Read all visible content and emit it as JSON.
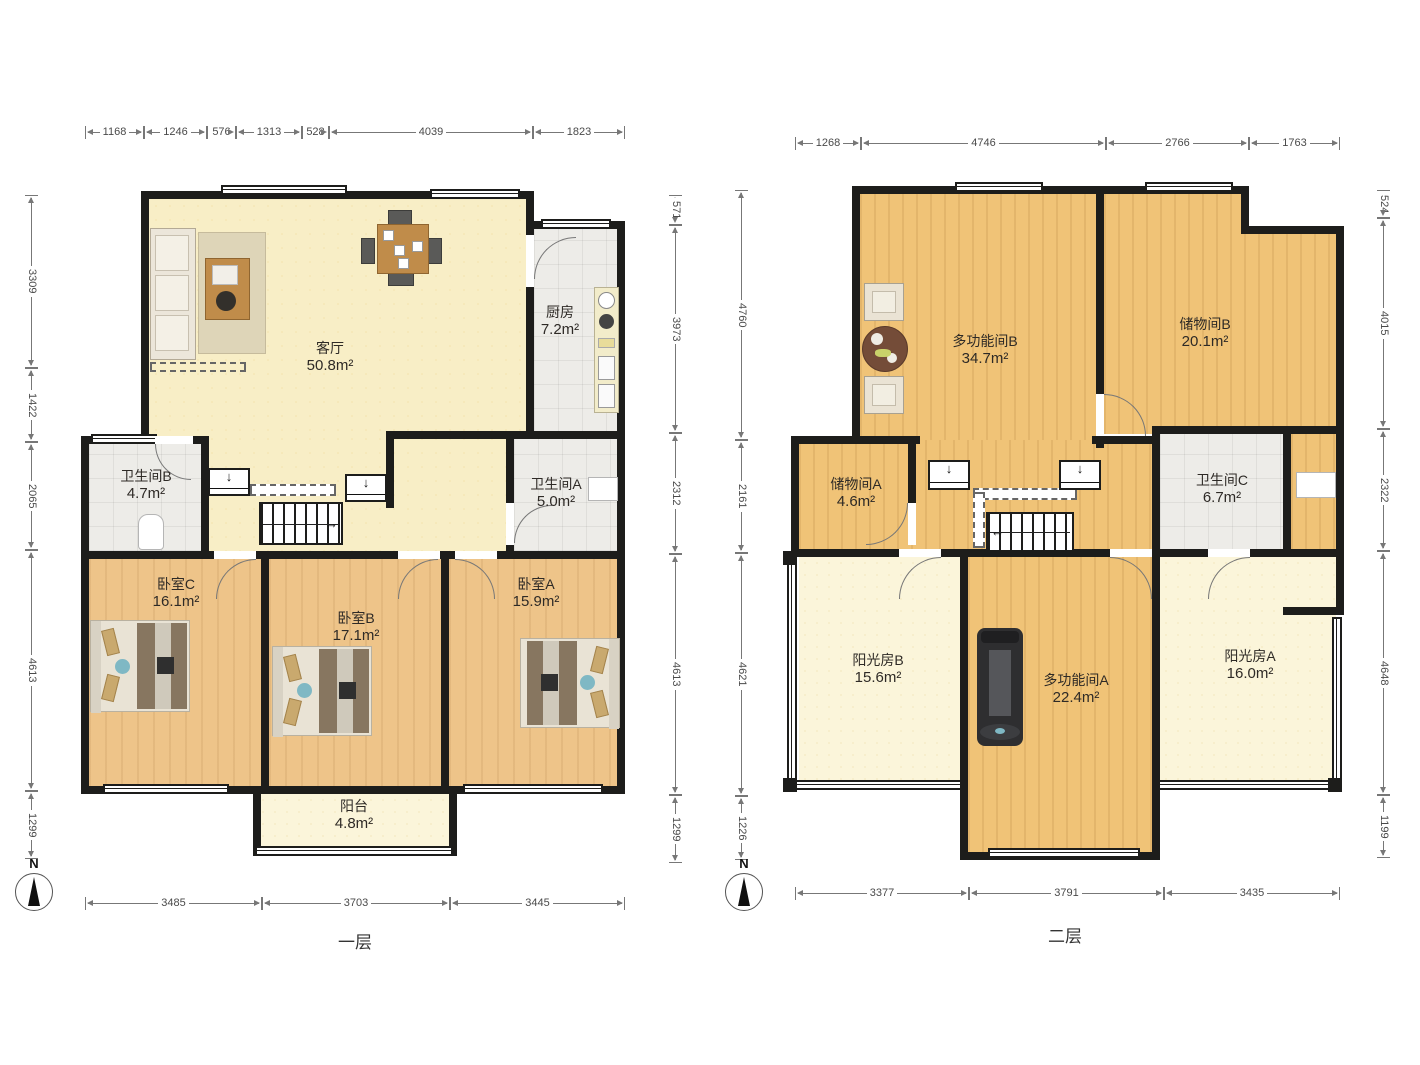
{
  "palette": {
    "wall": "#1d1d1b",
    "living_floor": "#f8eec6",
    "bedroom_floor": "#eec489",
    "upper_floor": "#f0c377",
    "tile_floor": "#edece8",
    "sunroom_floor": "#fbf5da",
    "dimension_text": "#4a4a4a"
  },
  "compass": {
    "north": "N"
  },
  "icons": {
    "down_arrow": "↓",
    "arrow_right": "→",
    "arrow_left": "←"
  },
  "floor1": {
    "label": "一层",
    "rooms": [
      {
        "name": "客厅",
        "area": "50.8m²"
      },
      {
        "name": "厨房",
        "area": "7.2m²"
      },
      {
        "name": "卫生间B",
        "area": "4.7m²"
      },
      {
        "name": "卫生间A",
        "area": "5.0m²"
      },
      {
        "name": "卧室C",
        "area": "16.1m²"
      },
      {
        "name": "卧室B",
        "area": "17.1m²"
      },
      {
        "name": "卧室A",
        "area": "15.9m²"
      },
      {
        "name": "阳台",
        "area": "4.8m²"
      }
    ],
    "dims": {
      "top": [
        "1168",
        "1246",
        "576",
        "1313",
        "528",
        "4039",
        "1823"
      ],
      "left": [
        "3309",
        "1422",
        "2065",
        "4613",
        "1299"
      ],
      "right": [
        "571",
        "3973",
        "2312",
        "4613",
        "1299"
      ],
      "bottom": [
        "3485",
        "3703",
        "3445"
      ]
    }
  },
  "floor2": {
    "label": "二层",
    "rooms": [
      {
        "name": "多功能间B",
        "area": "34.7m²"
      },
      {
        "name": "储物间B",
        "area": "20.1m²"
      },
      {
        "name": "储物间A",
        "area": "4.6m²"
      },
      {
        "name": "卫生间C",
        "area": "6.7m²"
      },
      {
        "name": "阳光房B",
        "area": "15.6m²"
      },
      {
        "name": "多功能间A",
        "area": "22.4m²"
      },
      {
        "name": "阳光房A",
        "area": "16.0m²"
      }
    ],
    "dims": {
      "top": [
        "1268",
        "4746",
        "2766",
        "1763"
      ],
      "left": [
        "4760",
        "2161",
        "4621",
        "1226"
      ],
      "right": [
        "524",
        "4015",
        "2322",
        "4648",
        "1199"
      ],
      "bottom": [
        "3377",
        "3791",
        "3435"
      ]
    }
  }
}
